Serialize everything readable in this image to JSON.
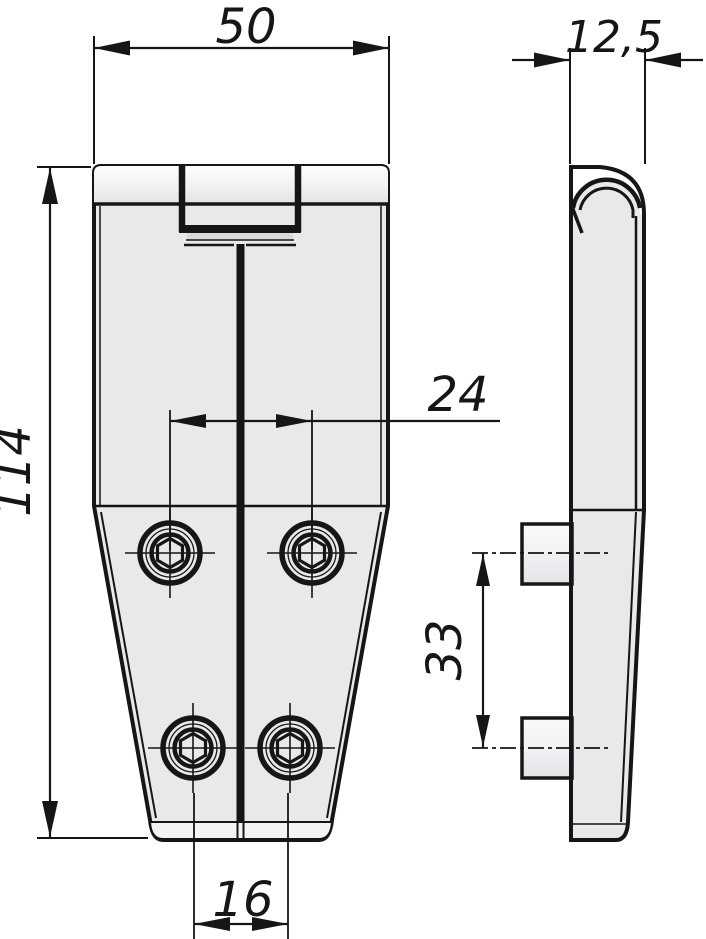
{
  "drawing": {
    "background_color": "#ffffff",
    "line_color": "#161616",
    "fill_color": "#e9e9ec",
    "band_highlight_color": "#fbfbfd",
    "dimensions": {
      "width": {
        "value": "50"
      },
      "thickness": {
        "value": "12,5"
      },
      "height": {
        "value": "114"
      },
      "upper_hole_spacing": {
        "value": "24"
      },
      "side_pin_spacing": {
        "value": "33"
      },
      "lower_hole_spacing": {
        "value": "16"
      }
    }
  }
}
